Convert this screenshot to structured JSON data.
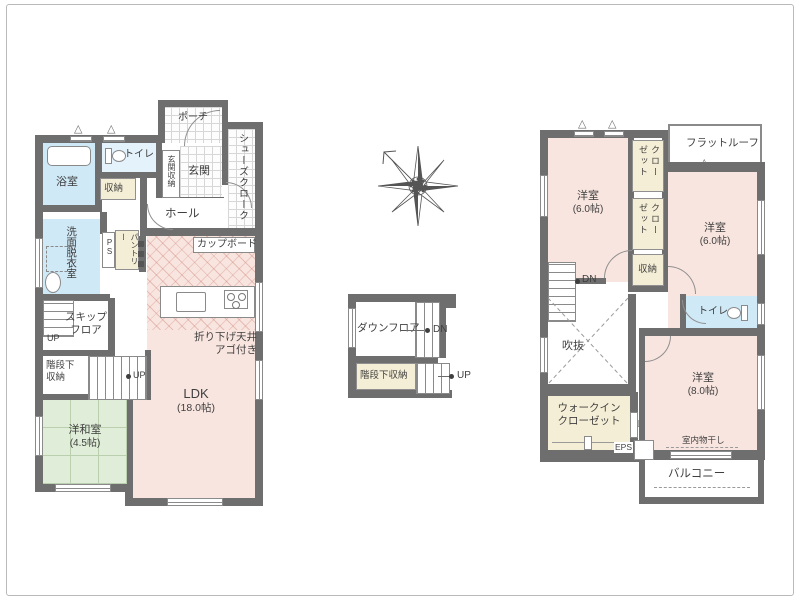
{
  "colors": {
    "wall": "#6e6e6e",
    "room_pink": "#f9e5df",
    "room_blue": "#cfe9f7",
    "room_green": "#e0edd8",
    "closet_cream": "#f5eed6"
  },
  "icons": {
    "vent_triangle": "△",
    "door_swing_arrow": "▷"
  },
  "floor1": {
    "porch": "ポーチ",
    "shoes_cloak": "シューズクローク",
    "toilet": "トイレ",
    "bath": "浴室",
    "storage": "収納",
    "entrance_storage": "玄関収納",
    "entrance": "玄関",
    "hall": "ホール",
    "washroom": "洗面脱衣室",
    "ps": "PS",
    "pantry": "パントリー",
    "cupboard": "カップボード",
    "skip_floor": "スキップフロア",
    "skip_up": "UP",
    "under_stair_storage": "階段下収納",
    "stair_up": "UP",
    "japanese_room_name": "洋和室",
    "japanese_room_size": "(4.5帖)",
    "ldk_name": "LDK",
    "ldk_size": "(18.0帖)",
    "ceiling_note_line1": "折り下げ天井",
    "ceiling_note_line2": "アゴ付き"
  },
  "mezzanine": {
    "down_floor": "ダウンフロア",
    "dn": "DN",
    "under_stair_storage": "階段下収納",
    "up": "UP"
  },
  "floor2": {
    "room_nw_name": "洋室",
    "room_nw_size": "(6.0帖)",
    "closet_a": "クローゼット",
    "closet_b": "クローゼット",
    "flat_roof": "フラットルーフ",
    "room_ne_name": "洋室",
    "room_ne_size": "(6.0帖)",
    "storage": "収納",
    "dn": "DN",
    "void": "吹抜",
    "toilet": "トイレ",
    "room_s_name": "洋室",
    "room_s_size": "(8.0帖)",
    "wic_line1": "ウォークイン",
    "wic_line2": "クローゼット",
    "eps": "EPS",
    "indoor_drying": "室内物干し",
    "balcony": "バルコニー"
  }
}
